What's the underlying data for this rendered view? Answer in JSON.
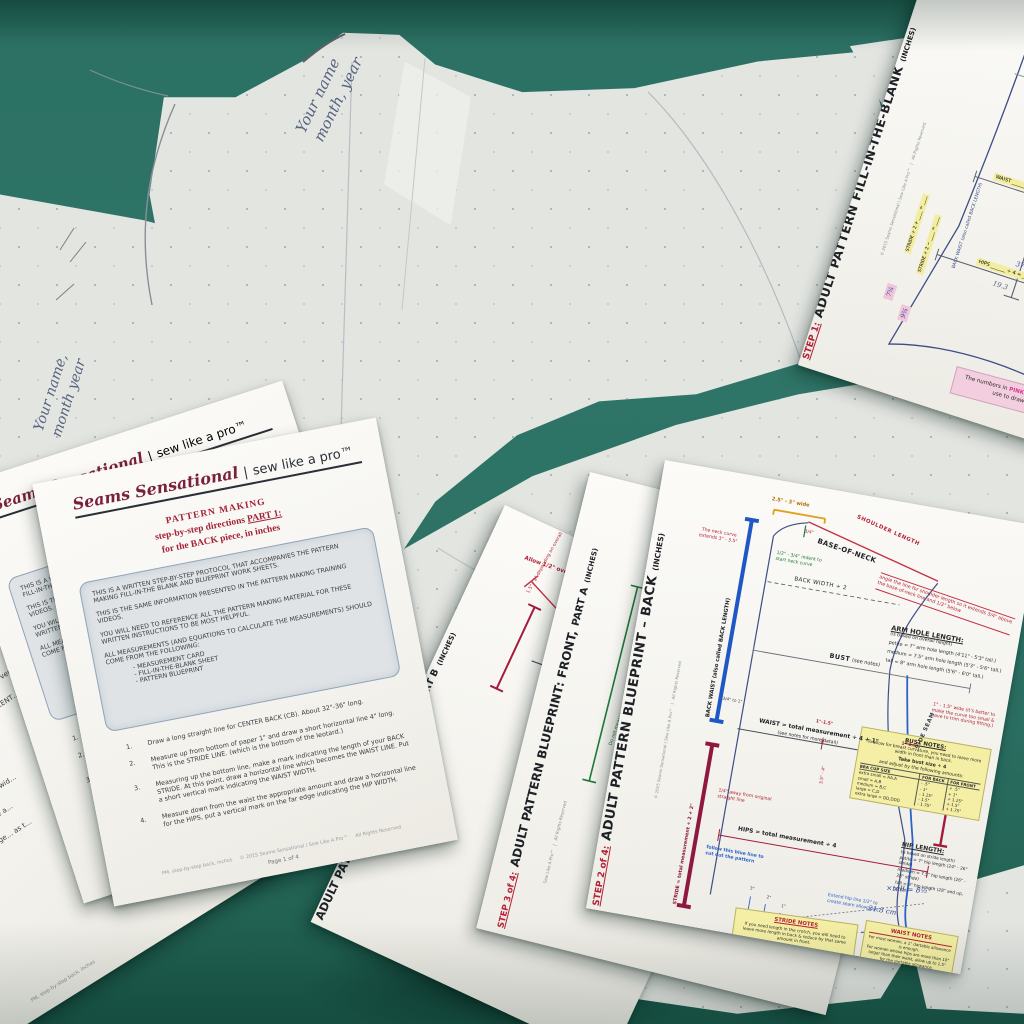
{
  "scene": {
    "surface_color": "#2b6f62",
    "paper_color": "#f4f3ee",
    "tissue_color": "#e3e5e1"
  },
  "handwriting": {
    "tissue_top": "Your name",
    "tissue_top2": "month, year",
    "tissue_left": "Your name,",
    "tissue_left2": "month year"
  },
  "instruction_sheet": {
    "brand": {
      "script": "Seams Sensational",
      "divider": "|",
      "tagline": "sew like a pro™"
    },
    "title_line1": "PATTERN MAKING",
    "title_line2_prefix": "step-by-step directions ",
    "title_line2_part": "PART 1:",
    "title_line3": "for the BACK piece, in inches",
    "intro_paragraphs": [
      "THIS IS A WRITTEN STEP-BY-STEP PROTOCOL THAT ACCOMPANIES THE PATTERN MAKING FILL-IN-THE BLANK AND BLUEPRINT WORK SHEETS.",
      "THIS IS THE SAME INFORMATION PRESENTED IN THE PATTERN MAKING TRAINING VIDEOS.",
      "YOU WILL NEED TO REFERENCE ALL THE PATTERN MAKING MATERIAL FOR THESE WRITTEN INSTRUCTIONS TO BE MOST HELPFUL.",
      "ALL MEASUREMENTS (AND EQUATIONS TO CALCULATE THE MEASUREMENTS) SHOULD COME FROM THE FOLLOWING:"
    ],
    "intro_bullets": [
      "-  MEASUREMENT CARD",
      "-  FILL-IN-THE-BLANK SHEET",
      "-  PATTERN BLUEPRINT"
    ],
    "steps": [
      {
        "num": "1.",
        "text": "Draw a long straight line for CENTER BACK (CB). About 32\"-36\" long."
      },
      {
        "num": "2.",
        "text": "Measure up from bottom of paper 1\" and draw a short horizontal line 4\" long. This is the STRIDE LINE. (which is the bottom of the leotard.)"
      },
      {
        "num": "3.",
        "text": "Measuring up the bottom line, make a mark indicating the length of your BACK STRIDE. At this point, draw a horizontal line which becomes the WAIST LINE. Put a short vertical mark indicating the WAIST WIDTH."
      },
      {
        "num": "4.",
        "text": "Measure down from the waist the appropriate amount and draw a horizontal line for the HIPS, put a vertical mark on the far edge indicating the HIP WIDTH."
      }
    ],
    "footer_left": "PM, step-by-step back, inches",
    "footer_center": "© 2015 Seams Sensational / Sew Like A Pro™",
    "footer_right": "All Rights Reserved",
    "page_label": "Page 1 of 4"
  },
  "left_sheet": {
    "items": [
      {
        "num": "2.",
        "text": "On a blank piece of …  draw a long, vertical …"
      },
      {
        "num": "3.",
        "text": "Place BACK PATT…  BACK, and CENT…  the waist down…"
      },
      {
        "num": "4.",
        "text": "Draw marks in…"
      },
      {
        "num": "5.",
        "text": "Remove the…"
      },
      {
        "num": "6.",
        "text": "Using a ru…  same wid…"
      },
      {
        "num": "7.",
        "text": "Measur…  place a…"
      },
      {
        "num": "8.",
        "text": "DOUB…  toge…  as t…"
      }
    ]
  },
  "fill_sheet": {
    "step_label": "STEP 1:",
    "title": "ADULT PATTERN FILL-IN-THE-BLANK",
    "title_suffix": "(INCHES)",
    "copyright": "© 2015   Seams Sensational | Sew Like A Pro™",
    "rights": "All Rights Reserved",
    "handwriting_top": "5'4\" → 163 = B/C cm",
    "back_length_label": "BACK WAIST (also called BACK LENGTH)",
    "fields": {
      "back_width": "BACK WIDTH ______ ÷ 2 = ______",
      "bust": "BUST ______ ÷ 4 = ______",
      "bust_note": "(see BUST NOTES)  + ____ = ____",
      "waist": "WAIST ______ ÷ 4 + 1 = ______",
      "hips": "HIPS ______ ÷ 4 = ______",
      "stride_back": "STRIDE ÷ 2 + ____ = ____",
      "stride_front": "STRIDE ÷ 2 − ____ = ____"
    },
    "handwritten": {
      "bust": "37½",
      "bust_result": "9.4",
      "waist_result": "21.2",
      "waist_cm": "+ 20 cm",
      "hips": "37.5",
      "hips_result": "9.4",
      "hips_alt": "19.3",
      "hips_cm": "+ 22 cm",
      "pink1": "7¾",
      "pink2": "9¾"
    },
    "pink_note": {
      "prefix": "The numbers in ",
      "pink": "PINK",
      "suffix": " are the numbers you will use to draw your pattern."
    }
  },
  "front_b_sheet": {
    "title": "ADULT PATTERN BLUEPRINT: FRONT,",
    "title_part": "PART B",
    "title_suffix": "(INCHES)",
    "rights": "All Rights Reserved",
    "overlap_note": "Allow 1/2\" overlap",
    "height_note": "1.5\" - 2\" depending on overall height",
    "cf_label": "CENTER FRONT LINE (CF)"
  },
  "front_a_sheet": {
    "step_label": "STEP 3 of 4:",
    "title": "ADULT PATTERN BLUEPRINT: FRONT,",
    "title_part": "PART A",
    "title_suffix": "(INCHES)",
    "brand": "Sew Like A Pro™",
    "rights": "All Rights Reserved",
    "green_note_1": "Do not measure this portion of the line.",
    "green_note_2": "…of the front is drawn on an angle to replicate how it is measured."
  },
  "back_sheet": {
    "step_label": "STEP 2 of 4:",
    "title": "ADULT PATTERN BLUEPRINT – BACK",
    "title_suffix": "(INCHES)",
    "copyright": "© 2015   Seams Sensational | Sew Like A Pro™",
    "rights": "All Rights Reserved",
    "back_length_label": "BACK WAIST (also called BACK LENGTH)",
    "stride_label": "STRIDE = total measurement ÷ 2 + 2\"",
    "neck_width": "2.5\" - 3\" wide",
    "shoulder_label": "SHOULDER LENGTH",
    "shoulder_offset": "3/4\"",
    "base_of_neck": "BASE-OF-NECK",
    "neck_curve_note": "The neck curve extends 3\" - 3.5\"",
    "neck_indent_note": "1/2\" - 3/4\" indent to start neck curve",
    "shoulder_angle_note": "angle the line for shoulder length so it extends 3/4\" above the base-of-neck line and 1/2\" below",
    "back_width": "BACK WIDTH ÷ 2",
    "armhole": {
      "title": "ARM HOLE LENGTH:",
      "subtitle": "(is based on overall height)",
      "rows": [
        "petite = 7\" arm hole length (4'11\" - 5'3\" tall.)",
        "medium = 7.5\" arm hole length (5'3\" - 5'6\" tall.)",
        "tall = 8\" arm hole length (5'6\" - 6'0\" tall.)"
      ]
    },
    "bust_label": "BUST",
    "bust_suffix": "(see notes)",
    "curve_note": "1\" - 1.5\" wide (it's better to make the curve too small & have to trim during fitting.)",
    "waist_label": "WAIST = total measurement ÷ 4 + 1\"",
    "waist_sub": "(see notes for more detail)",
    "waist_tick": "1\"-1.5\"",
    "waist_tick2": "3.5\" - 4\"",
    "cb_tick": "3/4\" to 1\"",
    "side_seam": "SIDE SEAM",
    "hips_label": "HIPS = total measurement ÷ 4",
    "quarter_note": "1/4\" away from original straight line",
    "blue_cut_note": "follow this blue line to cut out the pattern",
    "hip_extend_note": "Extend hip line 1/2\" to create seam allowance",
    "hip_length": {
      "title": "HIP LENGTH:",
      "subtitle": "(is based on stride length)",
      "rows": [
        "petite = 7\" hip length (24\" - 26\" stride)",
        "medium = 7.5\" hip length (26\" - 28\" stride)",
        "tall = 8\" hip length (28\" and up, stride)"
      ]
    },
    "bust_notes": {
      "title": "BUST NOTES:",
      "line1": "To allow for breast curvature, you need to leave more width in front than in back.",
      "line2a": "Take bust size ÷ 4",
      "line2b": "and adjust by the following amounts:",
      "cols": [
        "BRA CUP SIZE",
        "FOR BACK",
        "FOR FRONT"
      ],
      "rows": [
        [
          "extra small = AA,A",
          "- .5\"",
          "+ .5\""
        ],
        [
          "small = A,B",
          "- 1\"",
          "+ 1\""
        ],
        [
          "medium = B,C",
          "- 1.25\"",
          "+ 1.25\""
        ],
        [
          "large = C,D",
          "- 1.5\"",
          "+ 1.5\""
        ],
        [
          "extra large = DD,DDD",
          "- 1.75\"",
          "+ 1.75\""
        ]
      ]
    },
    "stride_notes": {
      "title": "STRIDE NOTES",
      "line1": "If you need length in the crotch, you will need to leave more length in back & reduce by that same amount in front.",
      "line2": "(back) STRIDE ÷ 2 = _____ + 4\" = _____",
      "line3": "(front) STRIDE ÷ 2 = _____ - 4\" = _____"
    },
    "waist_notes": {
      "title": "WAIST NOTES",
      "line1": "For most women, a 1\" dartable allowance is enough.",
      "line2": "For women whose hips are more than 10\" larger than their waist, allow up to 1.5\" for the dartable allowance.",
      "line3": "For women whose waist & hips are similar size (6\" or less difference), do a 3/4\" CB cut away with a 1\" dartable allowance."
    },
    "handwriting": {
      "a": "×tall = 8½\"",
      "b": "21.8 cm"
    },
    "crotch_ticks": [
      "3\"",
      "2\"",
      "1\""
    ]
  }
}
